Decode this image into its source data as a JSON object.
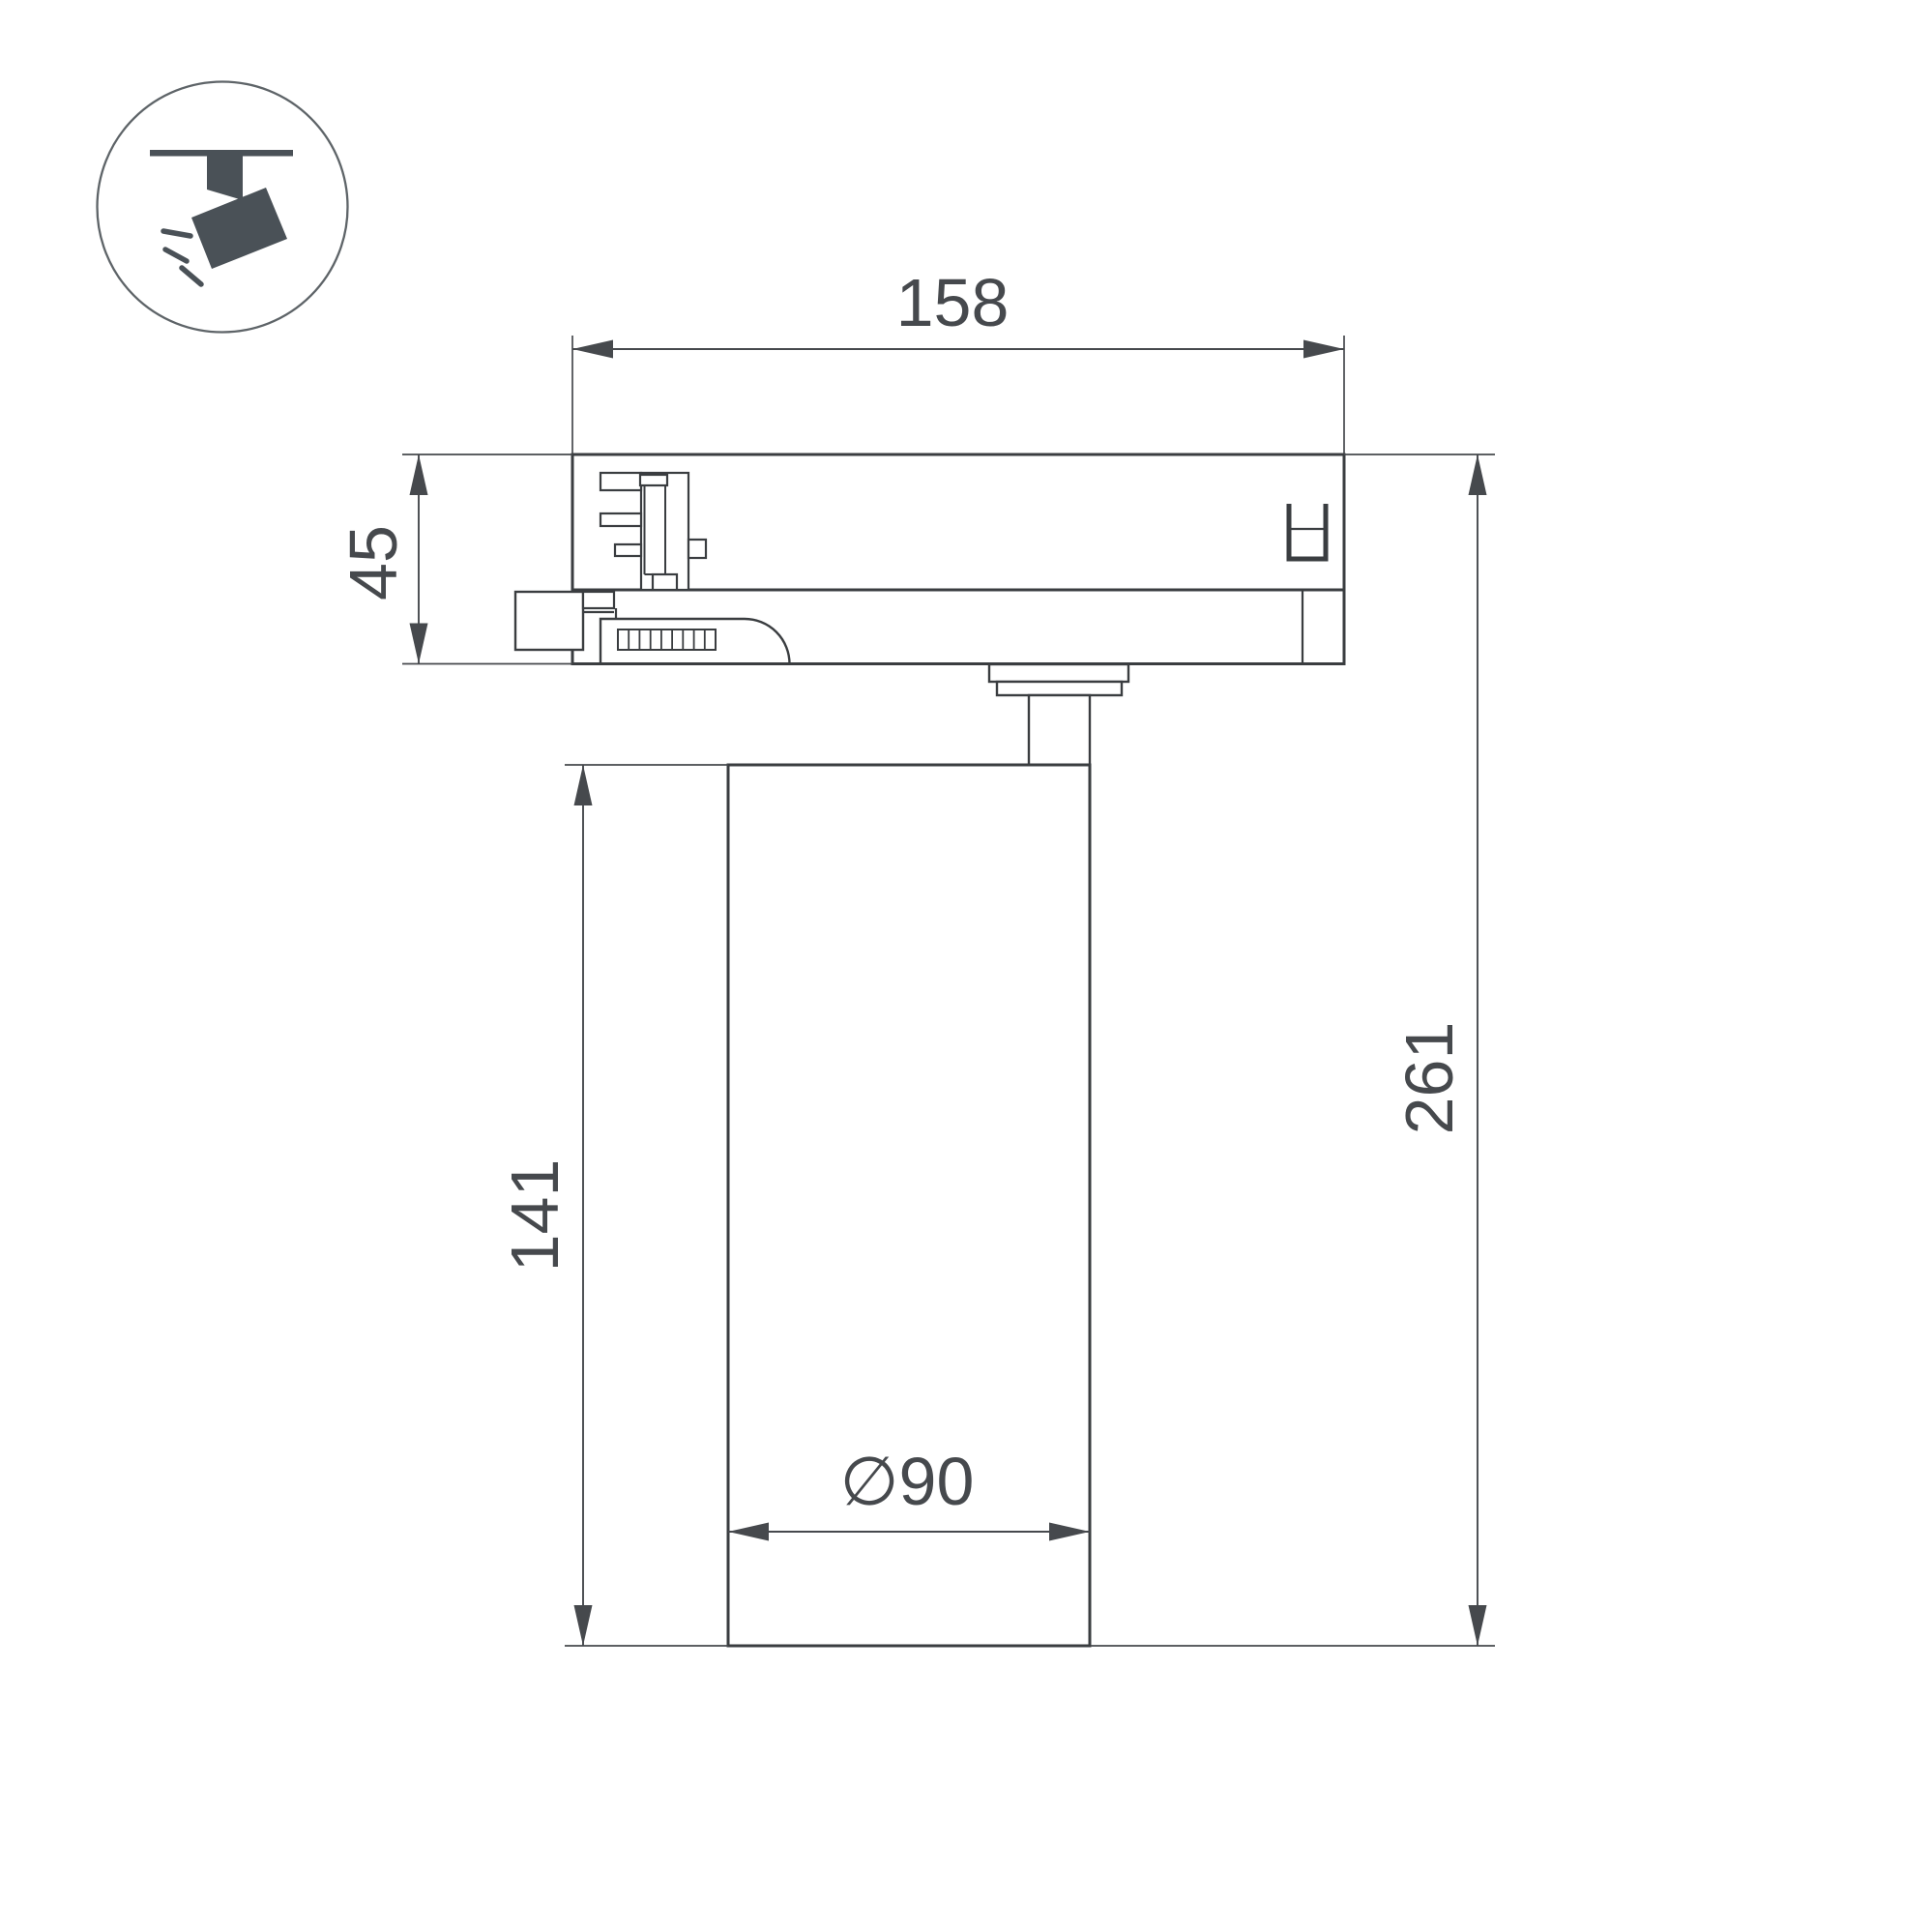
{
  "page": {
    "background": "#ffffff",
    "object_line_color": "#3a3d40",
    "dimension_color": "#46494d",
    "icon_color": "#4a5157"
  },
  "icon": {
    "name": "track-spotlight-pictogram"
  },
  "dimensions": {
    "track_adapter_width": "158",
    "track_adapter_height": "45",
    "body_height": "141",
    "total_height": "261",
    "body_diameter": "∅90"
  }
}
